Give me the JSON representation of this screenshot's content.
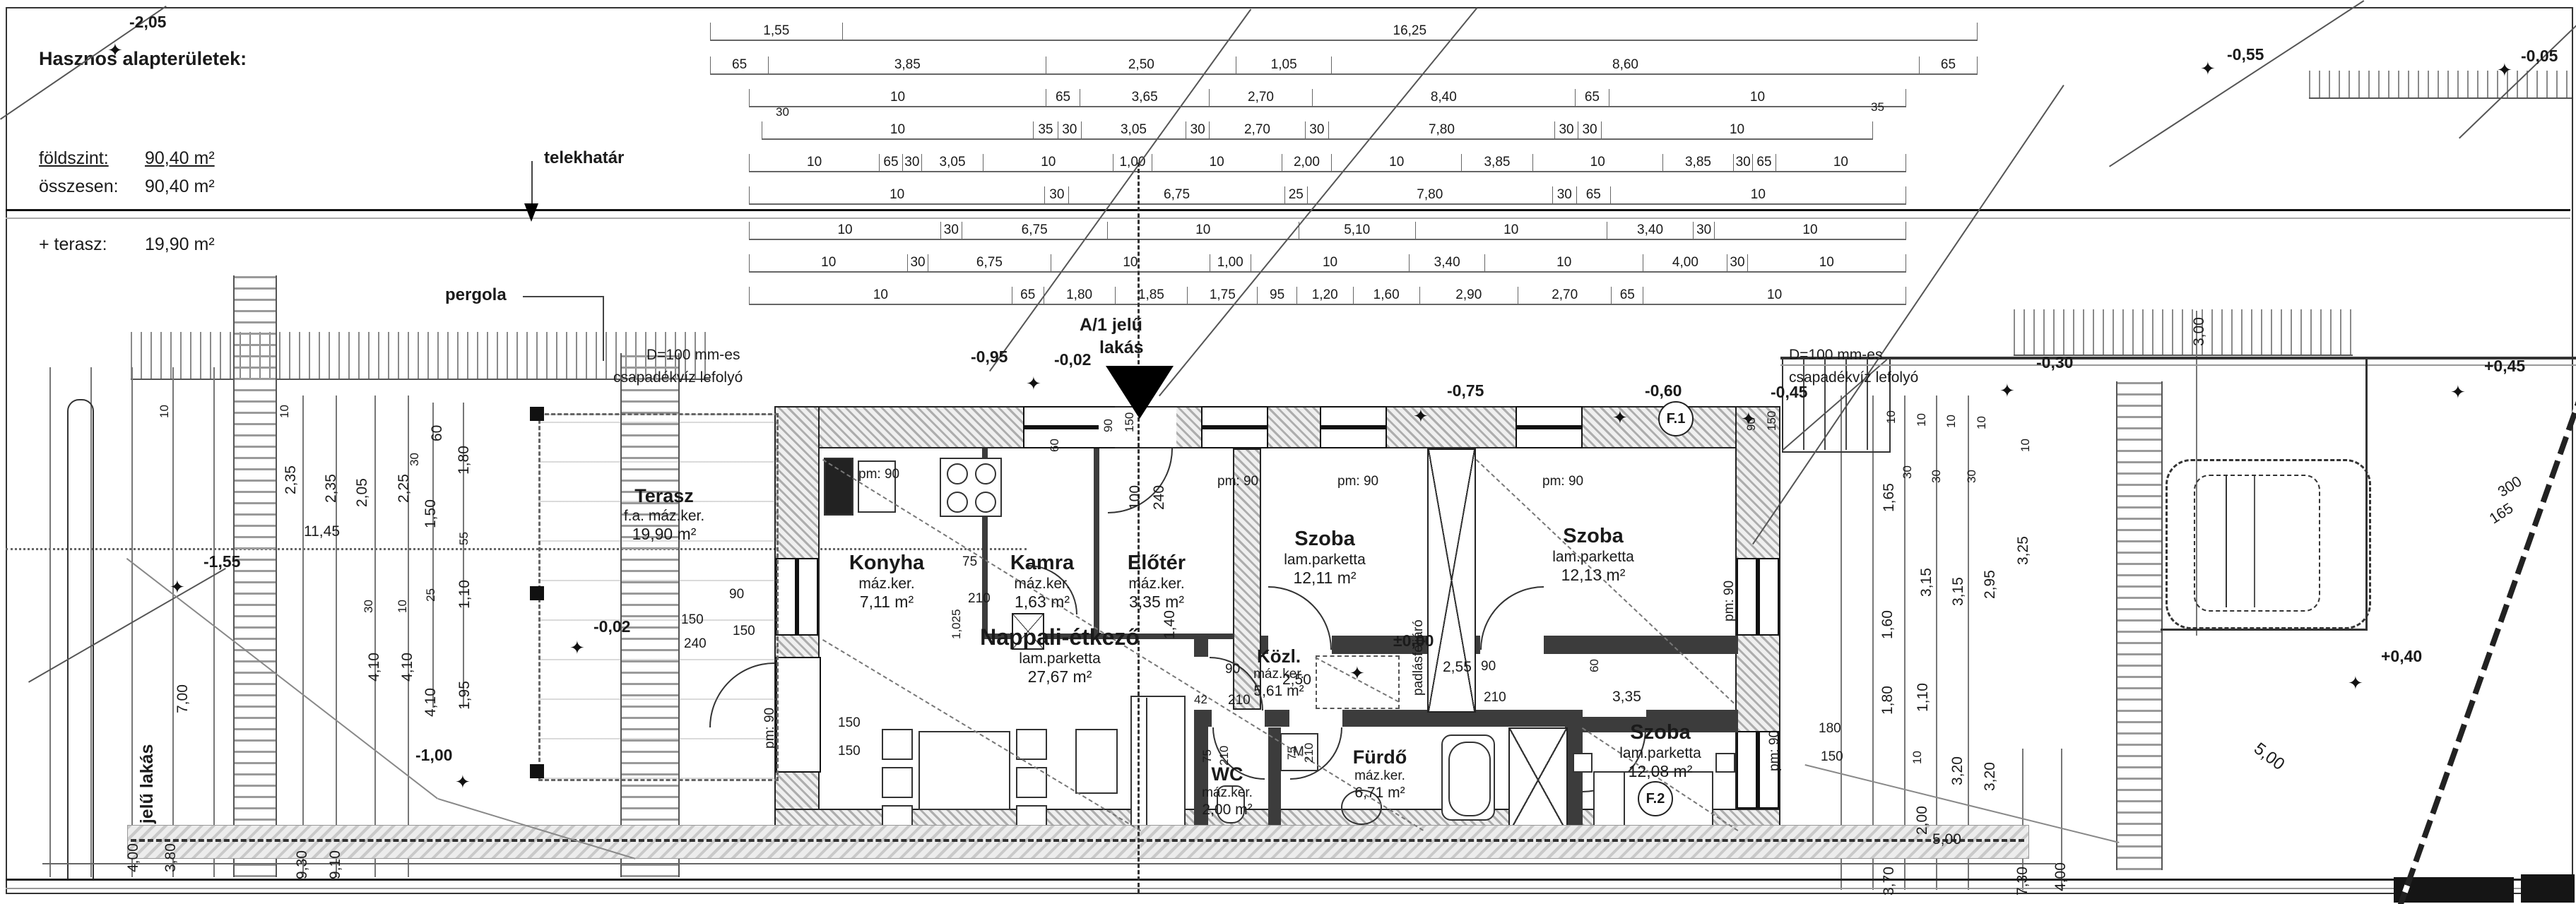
{
  "info_block": {
    "title": "Hasznos alapterületek:",
    "subtitle": "\"A/1\" jelű épület:",
    "rows": [
      {
        "label": "földszint:",
        "value": "90,40 m²"
      },
      {
        "label": "összesen:",
        "value": "90,40 m²"
      },
      {
        "label": "+ terasz:",
        "value": "19,90 m²"
      }
    ]
  },
  "labels": {
    "telekhatar": "telekhatár",
    "pergola": "pergola",
    "entrance_line1": "A/1 jelű",
    "entrance_line2": "lakás",
    "drain_left1": "D=100 mm-es",
    "drain_left2": "csapadékvíz lefolyó",
    "drain_right1": "D=100 mm-es",
    "drain_right2": "csapadékvíz lefolyó",
    "attic": "padlásfeljáró",
    "apartment": "A/1 jelű lakás",
    "f1": "F.1",
    "f2": "F.2",
    "washer": "M"
  },
  "icons": {
    "survey_marker": "✦"
  },
  "rooms": [
    {
      "name": "Terasz",
      "finish": "f.a. máz.ker.",
      "area": "19,90 m²"
    },
    {
      "name": "Konyha",
      "finish": "máz.ker.",
      "area": "7,11 m²"
    },
    {
      "name": "Kamra",
      "finish": "máz.ker.",
      "area": "1,63 m²"
    },
    {
      "name": "Előtér",
      "finish": "máz.ker.",
      "area": "3,35 m²"
    },
    {
      "name": "Szoba",
      "finish": "lam.parketta",
      "area": "12,11 m²"
    },
    {
      "name": "Szoba",
      "finish": "lam.parketta",
      "area": "12,13 m²"
    },
    {
      "name": "Nappali-étkező",
      "finish": "lam.parketta",
      "area": "27,67 m²"
    },
    {
      "name": "Közl.",
      "finish": "máz.ker.",
      "area": "5,61 m²"
    },
    {
      "name": "WC",
      "finish": "máz.ker.",
      "area": "2,00 m²"
    },
    {
      "name": "Fürdő",
      "finish": "máz.ker.",
      "area": "6,71 m²"
    },
    {
      "name": "Szoba",
      "finish": "lam.parketta",
      "area": "12,08 m²"
    }
  ],
  "levels": {
    "m205": "-2,05",
    "m155": "-1,55",
    "m100": "-1,00",
    "m095": "-0,95",
    "m002a": "-0,02",
    "m002b": "-0,02",
    "zero": "±0,00",
    "m075": "-0,75",
    "m060": "-0,60",
    "m045": "-0,45",
    "m030": "-0,30",
    "m055": "-0,55",
    "m005": "-0,05",
    "p045": "+0,45",
    "p040": "+0,40"
  },
  "dims": {
    "top_rows": [
      [
        "1,55",
        "16,25"
      ],
      [
        "65",
        "3,85",
        "2,50",
        "1,05",
        "8,60",
        "65"
      ],
      [
        "10",
        "65",
        "3,65",
        "2,70",
        "8,40",
        "65",
        "10"
      ],
      [
        "10",
        "35",
        "30",
        "3,05",
        "30",
        "2,70",
        "30",
        "7,80",
        "30",
        "30",
        "10"
      ],
      [
        "10",
        "65",
        "30",
        "3,05",
        "10",
        "1,00",
        "10",
        "2,00",
        "10",
        "3,85",
        "10",
        "3,85",
        "30",
        "65",
        "10"
      ],
      [
        "10",
        "30",
        "6,75",
        "25",
        "7,80",
        "30",
        "65",
        "10"
      ],
      [
        "10",
        "30",
        "6,75",
        "10",
        "5,10",
        "10",
        "3,40",
        "30",
        "10"
      ],
      [
        "10",
        "30",
        "6,75",
        "10",
        "1,00",
        "10",
        "3,40",
        "10",
        "4,00",
        "30",
        "10"
      ],
      [
        "10",
        "65",
        "1,80",
        "1,85",
        "1,75",
        "95",
        "1,20",
        "1,60",
        "2,90",
        "2,70",
        "65",
        "10"
      ]
    ],
    "scatter": [
      "30",
      "35",
      "7,00",
      "4,00",
      "3,80",
      "9,30",
      "9,10",
      "4,10",
      "4,10",
      "30",
      "10",
      "11,45",
      "2,35",
      "2,35",
      "2,05",
      "10",
      "10",
      "2,25",
      "30",
      "60",
      "1,80",
      "1,50",
      "55",
      "25",
      "1,10",
      "1,95",
      "4,10",
      "90",
      "150",
      "150",
      "240",
      "pm: 90",
      "pm: 90",
      "pm: 90",
      "pm: 90",
      "pm: 90",
      "pm: 90",
      "pm: 90",
      "90",
      "150",
      "60",
      "100",
      "240",
      "75",
      "210",
      "1,025",
      "2,50",
      "3,35",
      "2,55",
      "90",
      "210",
      "42",
      "90",
      "210",
      "60",
      "1,40",
      "75",
      "210",
      "75",
      "210",
      "180",
      "150",
      "10",
      "10",
      "10",
      "10",
      "10",
      "30",
      "30",
      "30",
      "1,65",
      "3,15",
      "3,15",
      "2,95",
      "3,25",
      "1,60",
      "1,80",
      "1,10",
      "10",
      "3,20",
      "3,20",
      "2,00",
      "5,00",
      "3,70",
      "7,30",
      "4,00",
      "3,00",
      "300",
      "165",
      "5,00",
      "150",
      "150",
      "90",
      "150"
    ]
  }
}
